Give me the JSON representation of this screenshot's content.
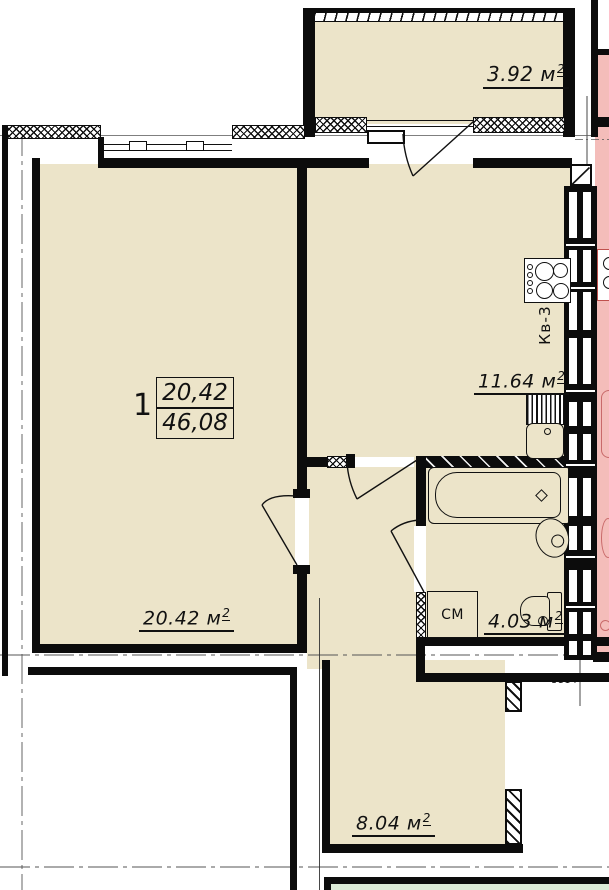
{
  "apartment": {
    "number": "1",
    "living_area": "20,42",
    "total_area": "46,08"
  },
  "labels": {
    "unit": "м",
    "sup": "2",
    "living_room": "20.42",
    "kitchen": "11.64",
    "bathroom": "4.03",
    "balcony_top": "3.92",
    "loggia_bottom": "8.04",
    "washing_machine": "СМ",
    "apartment_ref": "Кв-3",
    "dimension": "1114"
  },
  "colors": {
    "room_fill": "#ece4c9",
    "adjacent_fill": "#f4bdba",
    "green_fill": "#dcebd7",
    "wall": "#0c0c0c"
  }
}
